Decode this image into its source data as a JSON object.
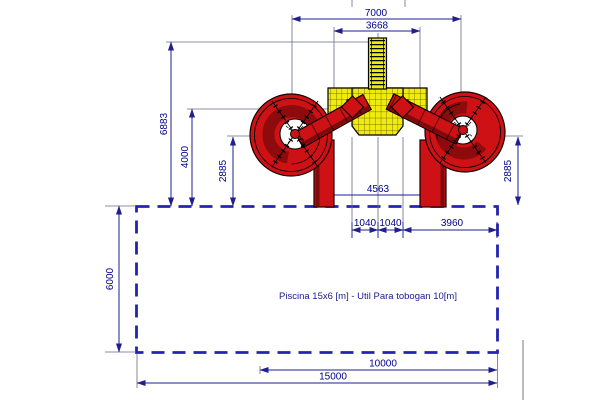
{
  "drawing": {
    "type": "cad-top-view-waterslide-and-pool",
    "label": "Piscina 15x6 [m] - Util Para tobogan 10[m]",
    "dims": {
      "d7000": "7000",
      "d3668": "3668",
      "d6883": "6883",
      "d4000": "4000",
      "d2885_left": "2885",
      "d2885_right": "2885",
      "d4563": "4563",
      "d1040_left": "1040",
      "d1040_right": "1040",
      "d3960": "3960",
      "d6000": "6000",
      "d10000": "10000",
      "d15000": "15000"
    },
    "colors": {
      "dimension_line": "#1F1F8F",
      "dimension_text": "#00008B",
      "pool_dashed_outline": "#2323B4",
      "slide_red": "#CE1114",
      "slide_dark_red": "#7E0A0C",
      "platform_yellow": "#F0EB0D",
      "background": "#FFFFFF"
    }
  }
}
